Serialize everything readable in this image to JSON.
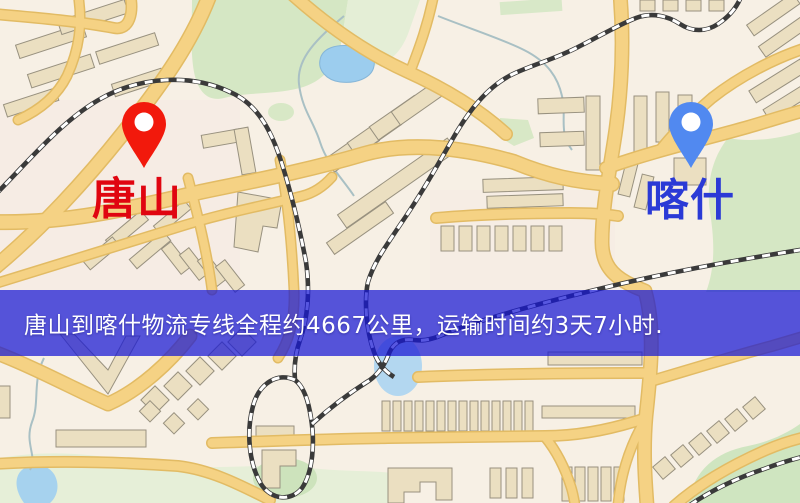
{
  "banner": {
    "text": "唐山到喀什物流专线全程约4667公里，运输时间约3天7小时.",
    "background_color": "#1616d4",
    "text_color": "#ffffff"
  },
  "markers": {
    "origin": {
      "label": "唐山",
      "pin_color": "#f2190c",
      "label_color": "#e00510"
    },
    "destination": {
      "label": "喀什",
      "pin_color": "#5189f0",
      "label_color": "#2b3ad6"
    }
  },
  "map_palette": {
    "background": "#f7f0e5",
    "road_fill": "#f5d284",
    "road_casing": "#e2bb64",
    "building_fill": "#ebdfc1",
    "building_outline": "#98917f",
    "park_green": "#d5e7c4",
    "water_blue": "#9ccdee",
    "railway_dark": "#3a3a3a"
  }
}
